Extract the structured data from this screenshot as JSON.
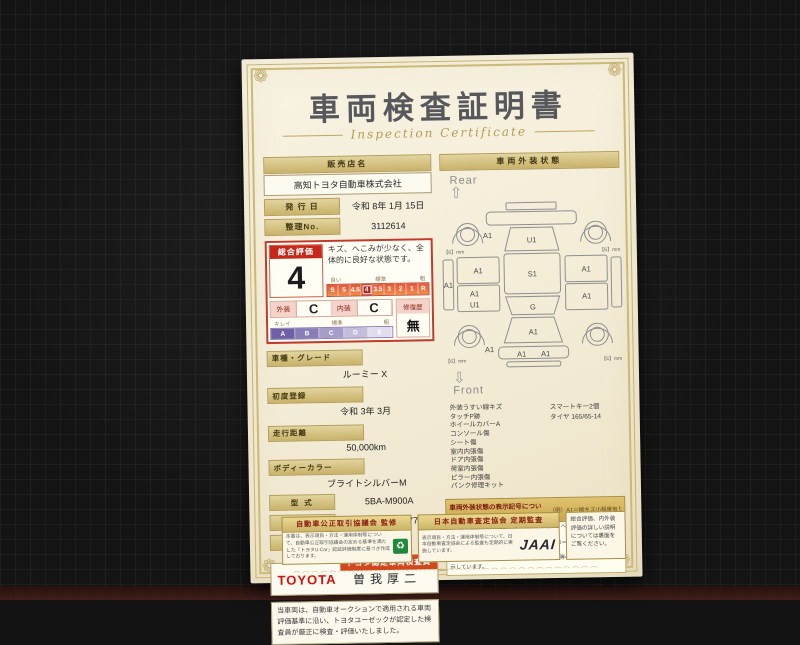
{
  "title": "車両検査証明書",
  "subtitle": "Inspection Certificate",
  "left": {
    "dealer_label": "販売店名",
    "dealer_value": "高知トヨタ自動車株式会社",
    "issue_label": "発 行 日",
    "issue_value": "令和 8年 1月 15日",
    "refno_label": "整理No.",
    "refno_value": "3112614",
    "rating": {
      "header": "総合評価",
      "score": "4",
      "comment": "キズ、へこみが少なく、全体的に良好な状態です。",
      "hints": [
        "良い",
        "標準",
        "粗"
      ],
      "scale": [
        "S",
        "5",
        "4.5",
        "4",
        "3.5",
        "3",
        "2",
        "1",
        "R"
      ],
      "selected": "4",
      "exterior_label": "外装",
      "exterior_grade": "C",
      "interior_label": "内装",
      "interior_grade": "C",
      "grade_hints": [
        "キレイ",
        "標準",
        "粗"
      ],
      "grade_scale": [
        "A",
        "B",
        "C",
        "D",
        "E"
      ],
      "repair_label": "修復歴",
      "repair_value": "無"
    },
    "fields": [
      {
        "label": "車種・グレード",
        "value": "ルーミー X"
      },
      {
        "label": "初度登録",
        "value": "令和 3年 3月"
      },
      {
        "label": "走行距離",
        "value": "50,000km"
      },
      {
        "label": "ボディーカラー",
        "value": "ブライトシルバーM"
      }
    ],
    "fields_inline": [
      {
        "label": "型  式",
        "value": "5BA-M900A"
      },
      {
        "label": "車台番号",
        "value": "XXXXXXX477"
      },
      {
        "label": "エンジン",
        "value": "ガソリン"
      }
    ],
    "inspector_banner": "トヨタ認定車両検査員",
    "brand": "TOYOTA",
    "inspector_name": "曽我厚二",
    "note": "当車両は、自動車オークションで適用される車両評価基準に沿い、トヨタユーゼックが認定した検査員が厳正に検査・評価いたしました。"
  },
  "right": {
    "header": "車両外装状態",
    "rear_label": "Rear",
    "front_label": "Front",
    "diagram_labels": [
      {
        "t": "A1",
        "x": 47,
        "y": 37
      },
      {
        "t": "U1",
        "x": 91,
        "y": 42
      },
      {
        "t": "S1",
        "x": 91,
        "y": 76
      },
      {
        "t": "A1",
        "x": 37,
        "y": 72
      },
      {
        "t": "A1",
        "x": 33,
        "y": 95
      },
      {
        "t": "U1",
        "x": 33,
        "y": 106
      },
      {
        "t": "A1",
        "x": 7,
        "y": 86
      },
      {
        "t": "A1",
        "x": 145,
        "y": 72
      },
      {
        "t": "A1",
        "x": 145,
        "y": 99
      },
      {
        "t": "G",
        "x": 91,
        "y": 109
      },
      {
        "t": "A1",
        "x": 91,
        "y": 134
      },
      {
        "t": "A1",
        "x": 47,
        "y": 151
      },
      {
        "t": "A1",
        "x": 79,
        "y": 156
      },
      {
        "t": "A1",
        "x": 103,
        "y": 156
      },
      {
        "t": "【6】mm",
        "x": 13,
        "y": 52,
        "s": 1
      },
      {
        "t": "【6】mm",
        "x": 169,
        "y": 52,
        "s": 1
      },
      {
        "t": "【6】mm",
        "x": 13,
        "y": 161,
        "s": 1
      },
      {
        "t": "【6】mm",
        "x": 169,
        "y": 161,
        "s": 1
      }
    ],
    "items_left": [
      "外装うすい線キズ",
      "タッチP跡",
      "ホイールカバーA",
      "コンソール傷",
      "シート傷",
      "室内内張傷",
      "ドア内張傷",
      "荷室内張傷",
      "ピラー内張傷",
      "パンク修理キット"
    ],
    "items_right": [
      "スマートキー2個",
      "タイヤ 165/65-14"
    ],
    "legend_title": "車両外装状態の表示記号について",
    "legend_example": "（例）A1＝線キズ小程度有り",
    "legend_lines": [
      "A＝線キズ有り U＝ヘコミ有り B＝キズを伴うヘコミ有り P＝要塗装 W＝補修歴有り S＝サビ有り",
      "C＝腐食有り G＝フロントガラス点キズ有り X＝要交換（裏面に記載あり） XX＝交換歴有り",
      "1＝小程度 2＝中程度 3＝中程度以上 ※タイヤ等の数字は、残り溝を表示しています。"
    ]
  },
  "footer": {
    "left_title": "自動車公正取引協議会 監修",
    "left_text": "本書は、表示項目・方法・運用体制等について、自動車公正取引協議会の定める基準を満たした「トヨタU-Car」認証評価制度に基づき作成しております。",
    "right_title": "日本自動車査定協会 定期監査",
    "right_text": "表示項目・方法・運用体制等について、日本自動車査定協会による監査も定期的に実施しています。",
    "jaai_logo": "JAAI",
    "back_note": "総合評価、内外装評価の詳しい説明については裏面をご覧ください。"
  },
  "icons": {
    "arrow_up": "⇧",
    "arrow_down": "⇩",
    "green_mark": "♻",
    "corner_flourish": "❁"
  },
  "colors": {
    "paper": "#f5efdc",
    "gold_bar": "#c9b26a",
    "accent_red": "#c23b2a",
    "toyota_red": "#d80f0f",
    "grade_purple": "#7e6fae",
    "green_cert": "#1f8a3e"
  }
}
